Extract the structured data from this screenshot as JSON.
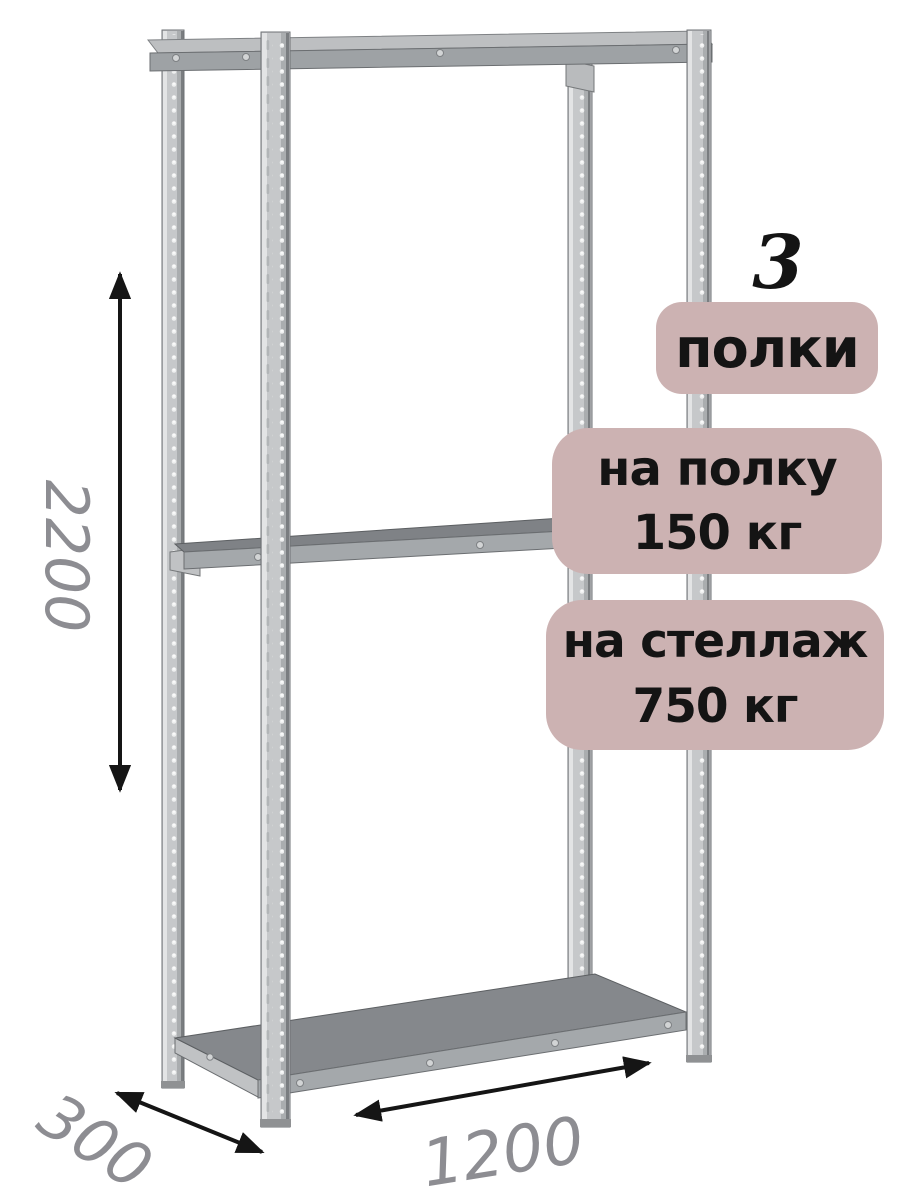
{
  "shelf_count": "3",
  "badges": {
    "shelves_label": "полки",
    "per_shelf": {
      "line1": "на полку",
      "line2": "150 кг"
    },
    "per_rack": {
      "line1": "на стеллаж",
      "line2": "750 кг"
    }
  },
  "dimensions": {
    "height": "2200",
    "depth": "300",
    "width": "1200"
  },
  "colors": {
    "background": "#ffffff",
    "badge_bg": "#ccb2b2",
    "badge_text": "#141414",
    "dimension_text": "#8d8d92",
    "arrow": "#151515",
    "metal_highlight": "#e3e4e5",
    "metal_base": "#c6c8ca",
    "metal_shade": "#a4a8ab",
    "shelf_top_dark": "#85888c"
  }
}
